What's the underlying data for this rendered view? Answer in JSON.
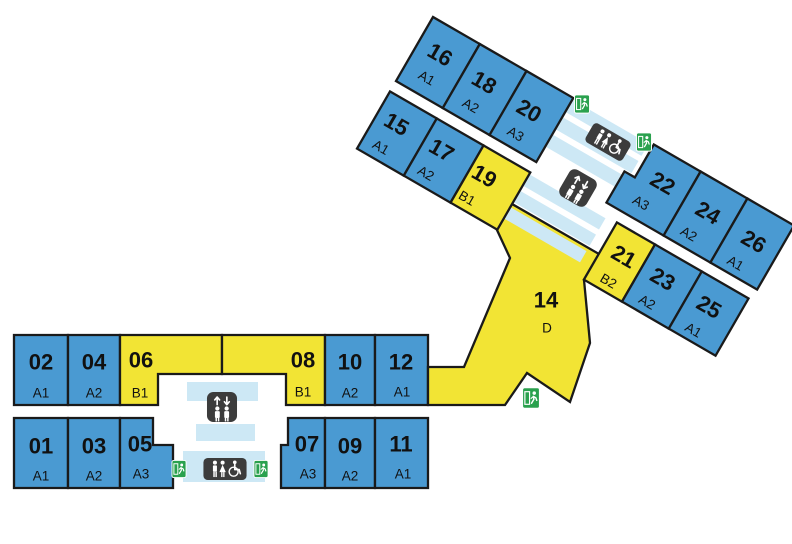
{
  "canvas": {
    "width": 792,
    "height": 544
  },
  "palette": {
    "room_blue": "#4a9ad2",
    "room_yellow": "#f2e434",
    "walkway_blue": "#cde8f5",
    "wall": "#1a1a1a",
    "icon_box": "#3c3c3c",
    "exit_green": "#2aa14e",
    "glyph": "#ffffff",
    "text": "#111111",
    "background": "#ffffff"
  },
  "groups": {
    "main": {
      "translate": [
        0,
        0
      ],
      "rotate": 0
    },
    "wing": {
      "translate": [
        433,
        17
      ],
      "rotate": 30
    }
  },
  "rooms": [
    {
      "group": "main",
      "number": "02",
      "code": "A1",
      "fill": "blue",
      "poly": [
        [
          14,
          335
        ],
        [
          68,
          335
        ],
        [
          68,
          405
        ],
        [
          14,
          405
        ]
      ],
      "num_xy": [
        41,
        362
      ],
      "code_xy": [
        41,
        393
      ]
    },
    {
      "group": "main",
      "number": "04",
      "code": "A2",
      "fill": "blue",
      "poly": [
        [
          68,
          335
        ],
        [
          120,
          335
        ],
        [
          120,
          405
        ],
        [
          68,
          405
        ]
      ],
      "num_xy": [
        94,
        362
      ],
      "code_xy": [
        94,
        393
      ]
    },
    {
      "group": "main",
      "number": "06",
      "code": "B1",
      "fill": "yellow",
      "poly": [
        [
          120,
          335
        ],
        [
          222,
          335
        ],
        [
          222,
          374
        ],
        [
          158,
          374
        ],
        [
          158,
          405
        ],
        [
          120,
          405
        ]
      ],
      "num_xy": [
        141,
        360
      ],
      "code_xy": [
        140,
        393
      ]
    },
    {
      "group": "main",
      "number": "08",
      "code": "B1",
      "fill": "yellow",
      "poly": [
        [
          222,
          335
        ],
        [
          325,
          335
        ],
        [
          325,
          405
        ],
        [
          286,
          405
        ],
        [
          286,
          374
        ],
        [
          222,
          374
        ]
      ],
      "num_xy": [
        303,
        360
      ],
      "code_xy": [
        303,
        392
      ]
    },
    {
      "group": "main",
      "number": "10",
      "code": "A2",
      "fill": "blue",
      "poly": [
        [
          325,
          335
        ],
        [
          375,
          335
        ],
        [
          375,
          405
        ],
        [
          325,
          405
        ]
      ],
      "num_xy": [
        350,
        362
      ],
      "code_xy": [
        350,
        393
      ]
    },
    {
      "group": "main",
      "number": "12",
      "code": "A1",
      "fill": "blue",
      "poly": [
        [
          375,
          335
        ],
        [
          428,
          335
        ],
        [
          428,
          405
        ],
        [
          375,
          405
        ]
      ],
      "num_xy": [
        401,
        362
      ],
      "code_xy": [
        402,
        392
      ]
    },
    {
      "group": "main",
      "number": "01",
      "code": "A1",
      "fill": "blue",
      "poly": [
        [
          14,
          418
        ],
        [
          68,
          418
        ],
        [
          68,
          488
        ],
        [
          14,
          488
        ]
      ],
      "num_xy": [
        41,
        446
      ],
      "code_xy": [
        41,
        476
      ]
    },
    {
      "group": "main",
      "number": "03",
      "code": "A2",
      "fill": "blue",
      "poly": [
        [
          68,
          418
        ],
        [
          120,
          418
        ],
        [
          120,
          488
        ],
        [
          68,
          488
        ]
      ],
      "num_xy": [
        94,
        446
      ],
      "code_xy": [
        94,
        476
      ]
    },
    {
      "group": "main",
      "number": "05",
      "code": "A3",
      "fill": "blue",
      "poly": [
        [
          120,
          418
        ],
        [
          153,
          418
        ],
        [
          153,
          445
        ],
        [
          173,
          445
        ],
        [
          173,
          488
        ],
        [
          120,
          488
        ]
      ],
      "num_xy": [
        140,
        444
      ],
      "code_xy": [
        141,
        474
      ]
    },
    {
      "group": "main",
      "number": "07",
      "code": "A3",
      "fill": "blue",
      "poly": [
        [
          288,
          418
        ],
        [
          325,
          418
        ],
        [
          325,
          488
        ],
        [
          281,
          488
        ],
        [
          281,
          445
        ],
        [
          288,
          445
        ]
      ],
      "num_xy": [
        307,
        444
      ],
      "code_xy": [
        308,
        474
      ]
    },
    {
      "group": "main",
      "number": "09",
      "code": "A2",
      "fill": "blue",
      "poly": [
        [
          325,
          418
        ],
        [
          375,
          418
        ],
        [
          375,
          488
        ],
        [
          325,
          488
        ]
      ],
      "num_xy": [
        350,
        446
      ],
      "code_xy": [
        350,
        476
      ]
    },
    {
      "group": "main",
      "number": "11",
      "code": "A1",
      "fill": "blue",
      "poly": [
        [
          375,
          418
        ],
        [
          428,
          418
        ],
        [
          428,
          488
        ],
        [
          375,
          488
        ]
      ],
      "num_xy": [
        401,
        444
      ],
      "code_xy": [
        403,
        474
      ]
    },
    {
      "group": "main",
      "number": "14",
      "code": "D",
      "fill": "yellow",
      "poly": [
        [
          428,
          367
        ],
        [
          464,
          367
        ],
        [
          510,
          258
        ],
        [
          497,
          230
        ],
        [
          512,
          204
        ],
        [
          599,
          254
        ],
        [
          584,
          280
        ],
        [
          590,
          343
        ],
        [
          570,
          402
        ],
        [
          527,
          373
        ],
        [
          505,
          405
        ],
        [
          428,
          405
        ]
      ],
      "num_xy": [
        546,
        300
      ],
      "code_xy": [
        547,
        328
      ]
    },
    {
      "group": "wing",
      "number": "16",
      "code": "A1",
      "fill": "blue",
      "poly": [
        [
          0,
          0
        ],
        [
          54,
          0
        ],
        [
          54,
          74
        ],
        [
          0,
          74
        ]
      ],
      "num_xy": [
        25,
        29
      ],
      "code_xy": [
        25,
        56
      ]
    },
    {
      "group": "wing",
      "number": "18",
      "code": "A2",
      "fill": "blue",
      "poly": [
        [
          54,
          0
        ],
        [
          108,
          0
        ],
        [
          108,
          74
        ],
        [
          54,
          74
        ]
      ],
      "num_xy": [
        77,
        31
      ],
      "code_xy": [
        77,
        58
      ]
    },
    {
      "group": "wing",
      "number": "20",
      "code": "A3",
      "fill": "blue",
      "poly": [
        [
          108,
          0
        ],
        [
          162,
          0
        ],
        [
          162,
          74
        ],
        [
          108,
          74
        ]
      ],
      "num_xy": [
        130,
        33
      ],
      "code_xy": [
        130,
        60
      ]
    },
    {
      "group": "wing",
      "number": "22",
      "code": "A3",
      "fill": "blue",
      "poly": [
        [
          255,
          0
        ],
        [
          309,
          0
        ],
        [
          309,
          74
        ],
        [
          243,
          74
        ],
        [
          243,
          38
        ],
        [
          255,
          38
        ]
      ],
      "num_xy": [
        282,
        29
      ],
      "code_xy": [
        273,
        57
      ]
    },
    {
      "group": "wing",
      "number": "24",
      "code": "A2",
      "fill": "blue",
      "poly": [
        [
          309,
          0
        ],
        [
          363,
          0
        ],
        [
          363,
          74
        ],
        [
          309,
          74
        ]
      ],
      "num_xy": [
        336,
        32
      ],
      "code_xy": [
        330,
        60
      ]
    },
    {
      "group": "wing",
      "number": "26",
      "code": "A1",
      "fill": "blue",
      "poly": [
        [
          363,
          0
        ],
        [
          417,
          0
        ],
        [
          417,
          74
        ],
        [
          363,
          74
        ]
      ],
      "num_xy": [
        390,
        34
      ],
      "code_xy": [
        385,
        62
      ]
    },
    {
      "group": "wing",
      "number": "15",
      "code": "A1",
      "fill": "blue",
      "poly": [
        [
          0,
          86
        ],
        [
          54,
          86
        ],
        [
          54,
          152
        ],
        [
          0,
          152
        ]
      ],
      "num_xy": [
        22,
        111
      ],
      "code_xy": [
        20,
        139
      ]
    },
    {
      "group": "wing",
      "number": "17",
      "code": "A2",
      "fill": "blue",
      "poly": [
        [
          54,
          86
        ],
        [
          108,
          86
        ],
        [
          108,
          152
        ],
        [
          54,
          152
        ]
      ],
      "num_xy": [
        74,
        111
      ],
      "code_xy": [
        72,
        139
      ]
    },
    {
      "group": "wing",
      "number": "19",
      "code": "B1",
      "fill": "yellow",
      "poly": [
        [
          108,
          86
        ],
        [
          162,
          86
        ],
        [
          162,
          152
        ],
        [
          108,
          152
        ]
      ],
      "num_xy": [
        124,
        112
      ],
      "code_xy": [
        120,
        140
      ]
    },
    {
      "group": "wing",
      "number": "21",
      "code": "B2",
      "fill": "yellow",
      "poly": [
        [
          262,
          86
        ],
        [
          306,
          86
        ],
        [
          306,
          152
        ],
        [
          262,
          152
        ]
      ],
      "num_xy": [
        285,
        112
      ],
      "code_xy": [
        284,
        141
      ]
    },
    {
      "group": "wing",
      "number": "23",
      "code": "A2",
      "fill": "blue",
      "poly": [
        [
          306,
          86
        ],
        [
          360,
          86
        ],
        [
          360,
          152
        ],
        [
          306,
          152
        ]
      ],
      "num_xy": [
        330,
        112
      ],
      "code_xy": [
        328,
        140
      ]
    },
    {
      "group": "wing",
      "number": "25",
      "code": "A1",
      "fill": "blue",
      "poly": [
        [
          360,
          86
        ],
        [
          414,
          86
        ],
        [
          414,
          152
        ],
        [
          360,
          152
        ]
      ],
      "num_xy": [
        384,
        113
      ],
      "code_xy": [
        382,
        141
      ]
    }
  ],
  "walkway_bands": [
    {
      "group": "main",
      "rect": [
        187,
        382,
        71,
        19
      ]
    },
    {
      "group": "main",
      "rect": [
        196,
        424,
        59,
        17
      ]
    },
    {
      "group": "main",
      "rect": [
        183,
        451,
        82,
        31
      ]
    },
    {
      "group": "wing",
      "rect": [
        163,
        2,
        87,
        14
      ]
    },
    {
      "group": "wing",
      "rect": [
        163,
        22,
        87,
        14
      ]
    },
    {
      "group": "wing",
      "rect": [
        163,
        42,
        87,
        14
      ]
    },
    {
      "group": "wing",
      "rect": [
        163,
        88,
        87,
        13
      ]
    },
    {
      "group": "wing",
      "rect": [
        163,
        107,
        87,
        13
      ]
    },
    {
      "group": "wing",
      "rect": [
        163,
        126,
        87,
        13
      ]
    }
  ],
  "icons": [
    {
      "type": "elevator",
      "cx": 222,
      "cy": 407,
      "w": 31,
      "h": 31,
      "rotate": 0
    },
    {
      "type": "exit",
      "cx": 179,
      "cy": 469,
      "w": 15,
      "h": 21,
      "rotate": 0
    },
    {
      "type": "restroom",
      "cx": 225,
      "cy": 469,
      "w": 46,
      "h": 23,
      "rotate": 0
    },
    {
      "type": "exit",
      "cx": 261,
      "cy": 469,
      "w": 15,
      "h": 21,
      "rotate": 0
    },
    {
      "type": "exit",
      "cx": 531,
      "cy": 398,
      "w": 18,
      "h": 23,
      "rotate": 0
    },
    {
      "type": "exit",
      "cx": 582,
      "cy": 104,
      "w": 16,
      "h": 21,
      "rotate": 0
    },
    {
      "type": "restroom",
      "cx": 608,
      "cy": 142,
      "w": 44,
      "h": 26,
      "rotate": 30
    },
    {
      "type": "exit",
      "cx": 644,
      "cy": 142,
      "w": 16,
      "h": 22,
      "rotate": 0
    },
    {
      "type": "elevator",
      "cx": 578,
      "cy": 188,
      "w": 32,
      "h": 32,
      "rotate": 30
    }
  ]
}
